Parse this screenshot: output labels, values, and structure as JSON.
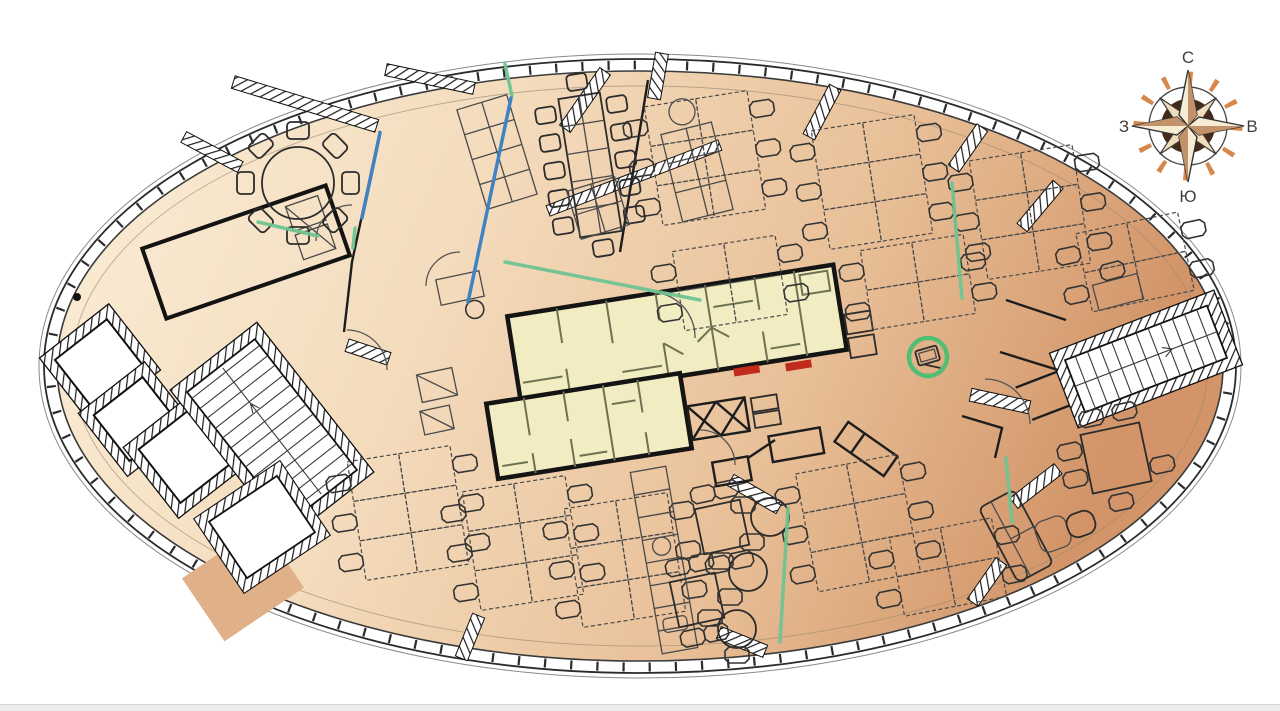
{
  "compass": {
    "north": "С",
    "east": "В",
    "south": "Ю",
    "west": "З"
  },
  "colors": {
    "floor_light": "#faeed8",
    "floor_mid": "#f4dcbd",
    "floor_dark": "#d29468",
    "floor_edge_dark": "#c98e63",
    "core_fill": "#f2ecc2",
    "partition_green": "#6fc392",
    "partition_blue": "#3f83c4",
    "marker_green": "#53bd74",
    "alert_red": "#c22b1c",
    "compass_orange": "#d8874a",
    "compass_hub": "#452a18",
    "scrollbar_track": "#ededed"
  }
}
